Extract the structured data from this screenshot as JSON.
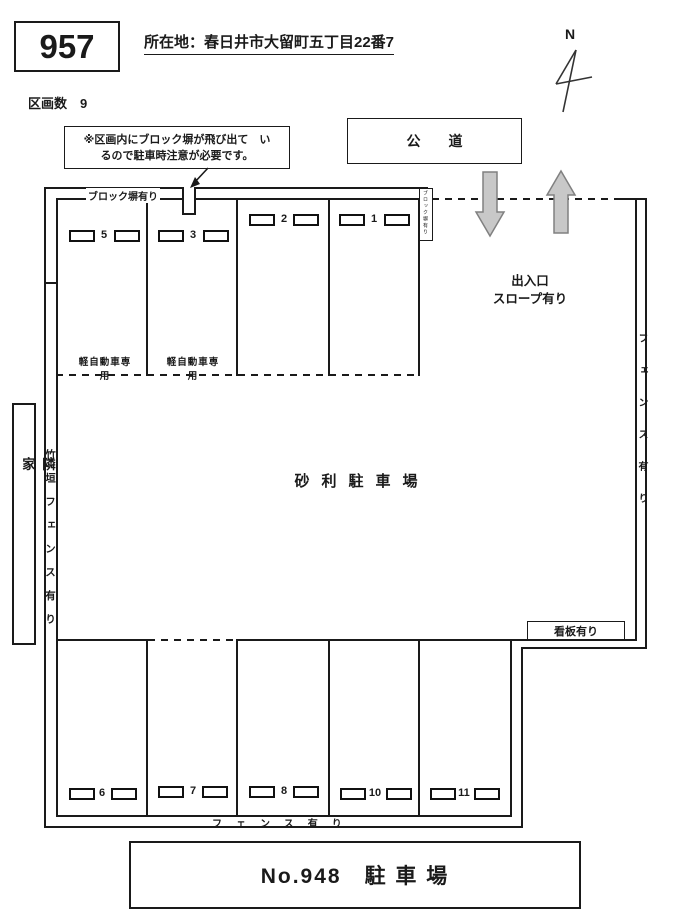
{
  "header": {
    "lot_number": "957",
    "address": "所在地：春日井市大留町五丁目22番7",
    "section_count": "区画数　9"
  },
  "note_box": {
    "line1": "※区画内にブロック塀が飛び出て　い",
    "line2": "るので駐車時注意が必要です。"
  },
  "road": {
    "label": "公　　道"
  },
  "compass": {
    "label": "N"
  },
  "annotations": {
    "block_wall": "ブロック塀有り",
    "block_wall_small_vertical": "ブロック塀有り",
    "entrance_line1": "出入口",
    "entrance_line2": "スロープ有り",
    "ground_type": "砂利駐車場",
    "signboard": "看板有り",
    "neighbor_house": "隣家",
    "bamboo_fence": "竹垣フェンス有り",
    "right_fence": "フェンス有り",
    "bottom_fence": "フェンス有り",
    "kei_car_only": "軽自動車専用"
  },
  "top_row": {
    "spaces": [
      {
        "number": "5",
        "kei_only": true
      },
      {
        "number": "3",
        "kei_only": true
      },
      {
        "number": "2",
        "kei_only": false
      },
      {
        "number": "1",
        "kei_only": false
      }
    ]
  },
  "bottom_row": {
    "spaces": [
      {
        "number": "6"
      },
      {
        "number": "7"
      },
      {
        "number": "8"
      },
      {
        "number": "10"
      },
      {
        "number": "11"
      }
    ]
  },
  "footer": {
    "title": "No.948　駐 車 場"
  },
  "colors": {
    "line": "#1a1a1a",
    "arrow_fill": "#c8c8c8",
    "arrow_stroke": "#808080"
  }
}
